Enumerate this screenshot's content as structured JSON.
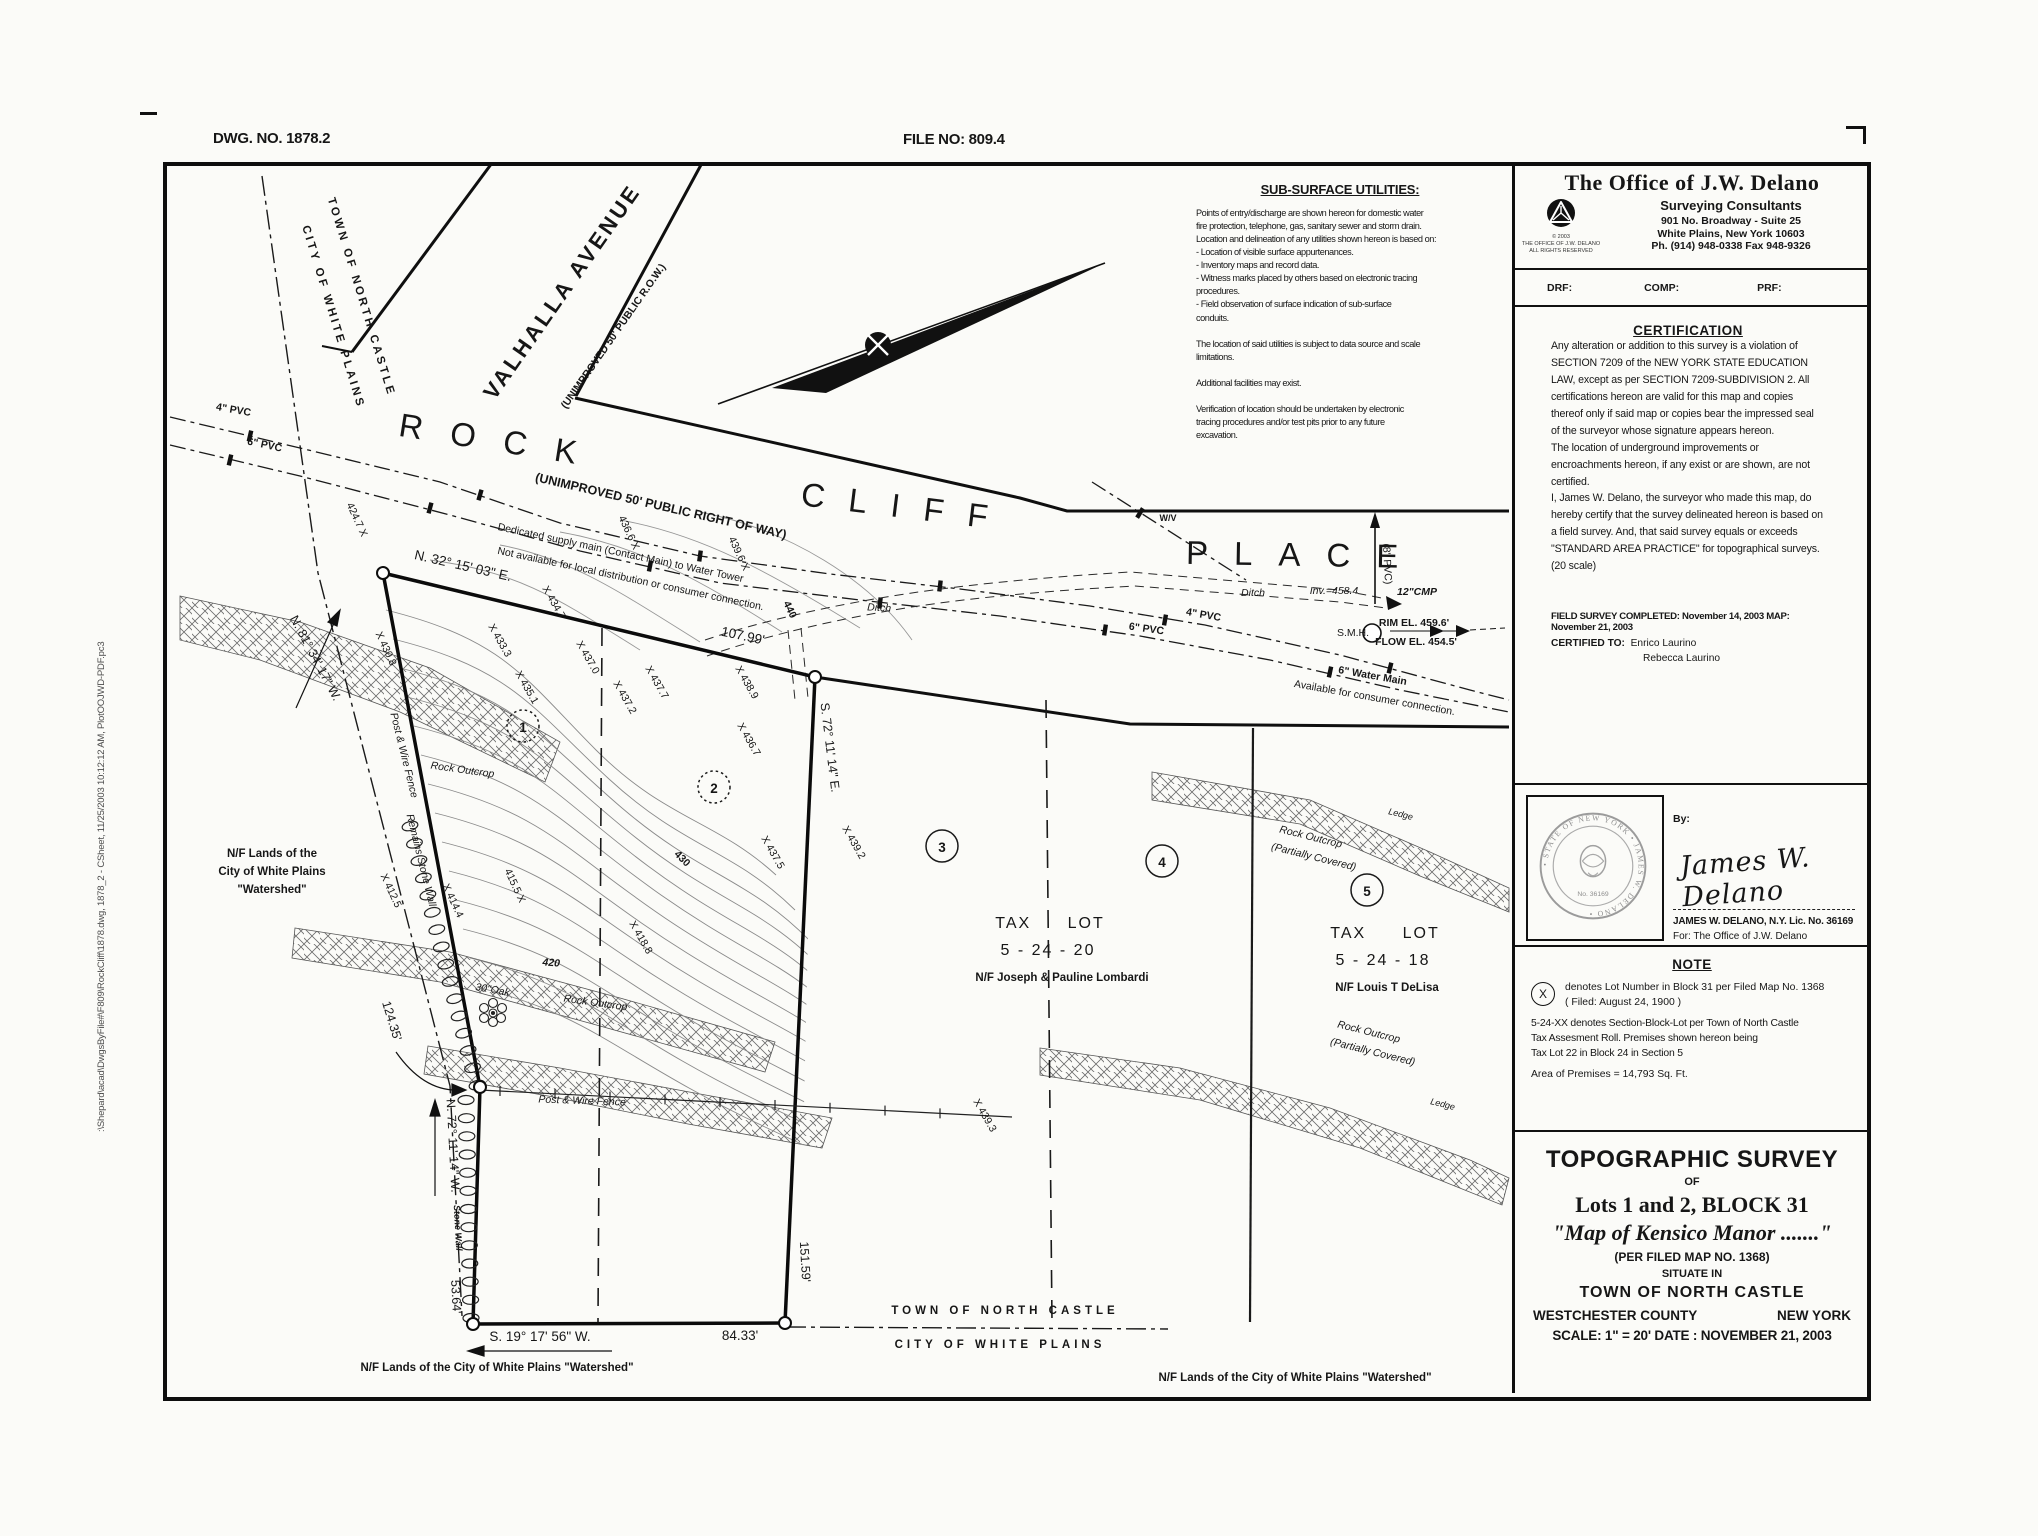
{
  "header": {
    "dwg_no": "DWG. NO.  1878.2",
    "file_no": "FILE NO:  809.4"
  },
  "plot_stamp": ":\\Shepard\\acad\\DwgsByFile#\\F809\\RockCliff\\1878.dwg, 1878_2 - CSheet, 11/25/2003 10:12:12 AM, PlotOOJWD-PDF.pc3",
  "firm": {
    "name": "The Office of J.W. Delano",
    "subtitle": "Surveying Consultants",
    "address1": "901 No. Broadway - Suite 25",
    "address2": "White Plains, New York 10603",
    "phone": "Ph. (914) 948-0338 Fax 948-9326",
    "copyright": "© 2003\nTHE OFFICE OF J.W. DELANO\nALL RIGHTS RESERVED",
    "drf": "DRF:",
    "comp": "COMP:",
    "prf": "PRF:"
  },
  "utilities": {
    "title": "SUB-SURFACE UTILITIES:",
    "body": "Points of entry/discharge are shown hereon for domestic water\nfire protection, telephone, gas, sanitary sewer and storm drain.\nLocation and delineation of any utilities shown hereon is based on:\n- Location of visible surface appurtenances.\n- Inventory maps and record data.\n- Witness marks placed by others based on electronic tracing\n   procedures.\n- Field observation of surface indication of sub-surface\n   conduits.\n\nThe location of said utilities is subject to data source and scale\nlimitations.\n\nAdditional facilities may exist.\n\nVerification of location should be undertaken by electronic\ntracing procedures and/or test pits prior to any future\nexcavation."
  },
  "certification": {
    "title": "CERTIFICATION",
    "para1": "Any alteration or addition to this survey is a violation of SECTION 7209 of the NEW YORK STATE EDUCATION LAW, except as per SECTION 7209-SUBDIVISION 2.  All certifications hereon are valid for this map and copies thereof only if said map or copies bear the impressed seal of the surveyor whose signature appears hereon.",
    "para2": "The location of underground improvements or encroachments hereon, if any exist or are shown, are not certified.",
    "para3": "I, James W. Delano, the surveyor who made this map, do hereby certify that the survey delineated hereon is based on a field survey.  And, that said survey equals or exceeds \"STANDARD AREA PRACTICE\" for topographical surveys. (20 scale)",
    "field_survey": "FIELD SURVEY COMPLETED:  November 14, 2003  MAP:  November 21, 2003",
    "certified_to_label": "CERTIFIED TO:",
    "certified_to_1": "Enrico Laurino",
    "certified_to_2": "Rebecca Laurino"
  },
  "signature": {
    "by_label": "By:",
    "script_name": "James W. Delano",
    "name_line": "JAMES W. DELANO, N.Y. Lic. No. 36169",
    "for_line": "For:  The Office of J.W. Delano",
    "seal_arc_text": "• STATE OF NEW YORK • JAMES W. DELANO •",
    "seal_no": "No. 36169"
  },
  "note": {
    "title": "NOTE",
    "symbol": "X",
    "item1a": "denotes Lot Number in Block 31 per Filed Map No. 1368",
    "item1b": "( Filed:  August 24, 1900 )",
    "item2": "5-24-XX denotes Section-Block-Lot per Town of North Castle\nTax Assesment Roll.  Premises shown hereon being\nTax Lot 22 in Block 24 in Section 5",
    "item3": "Area of Premises = 14,793 Sq. Ft."
  },
  "title_block": {
    "line1": "TOPOGRAPHIC SURVEY",
    "line2": "OF",
    "line3": "Lots 1 and 2, BLOCK 31",
    "line4": "\"Map of Kensico Manor .......\"",
    "line5": "(PER FILED MAP NO. 1368)",
    "line6": "SITUATE IN",
    "line7": "TOWN OF NORTH CASTLE",
    "county": "WESTCHESTER COUNTY",
    "state": "NEW YORK",
    "scale_date": "SCALE: 1\" = 20'    DATE : NOVEMBER 21, 2003"
  },
  "map": {
    "labels": {
      "town_top1": "TOWN OF NORTH CASTLE",
      "town_top2": "CITY OF WHITE PLAINS",
      "valhalla": "VALHALLA AVENUE",
      "valhalla_sub": "(UNIMPROVED 50' PUBLIC R.O.W.)",
      "rock": "ROCK",
      "cliff": "CLIFF",
      "place": "PLACE",
      "row_sub": "(UNIMPROVED 50' PUBLIC RIGHT OF WAY)",
      "ded1": "Dedicated supply main (Contact Main) to Water Tower",
      "ded2": "Not available for local distribution or consumer connection.",
      "brg_n32": "N. 32° 15' 03\" E.",
      "d10799": "107.99'",
      "brg_n81": "N. 81° 34' 17\" W.",
      "brg_s72": "S. 72° 11' 14\" E.",
      "d15159": "151.59'",
      "brg_s19": "S. 19° 17' 56\" W.",
      "d8433": "84.33'",
      "brg_n72": "N. 72° 11' 14\" W.",
      "stonewall": "Stone Wall",
      "d5364": "53.64'",
      "d12435": "124.35'",
      "nf_l1": "N/F Lands of the",
      "nf_l2": "City of White Plains",
      "nf_l3": "\"Watershed\"",
      "nf_bl": "N/F Lands of the City of White Plains \"Watershed\"",
      "nf_br": "N/F Lands of the City of White Plains \"Watershed\"",
      "town_bot": "TOWN OF NORTH CASTLE",
      "city_bot": "CITY OF WHITE PLAINS",
      "tl20_1": "TAX LOT",
      "tl20_2": "5 - 24 - 20",
      "tl20_3": "N/F Joseph & Pauline Lombardi",
      "tl18_1": "TAX LOT",
      "tl18_2": "5 - 24 - 18",
      "tl18_3": "N/F Louis T DeLisa",
      "lot1": "1",
      "lot2": "2",
      "lot3": "3",
      "lot4": "4",
      "lot5": "5",
      "s4247": "424.7 X",
      "s4308": "X 430.8",
      "s4333": "X 433.3",
      "s4347": "X 434.7",
      "s4351": "X 435.1",
      "s4370": "X 437.0",
      "s4372": "X 437.2",
      "s4377": "X 437.7",
      "s4389": "X 438.9",
      "s4367": "X 436.7",
      "s4366": "436.6 X",
      "s4396": "439.6 X",
      "c440": "440",
      "s4432": "X 443.2",
      "s4375": "X 437.5",
      "s4392": "X 439.2",
      "s4393": "X 439.3",
      "s4155": "415.5 X",
      "s4144": "X 414.4",
      "s4125": "X 412.5",
      "s4188": "X 418.8",
      "c420": "420",
      "c430": "430",
      "oak": "30\"Oak",
      "ro1": "Rock Outcrop",
      "ro2": "Rock Outcrop",
      "ro_rt1": "Rock Outcrop",
      "ro_rt2": "(Partially Covered)",
      "ledge_t": "Ledge",
      "ro_rb1": "Rock Outcrop",
      "ro_rb2": "(Partially Covered)",
      "ledge_b": "Ledge",
      "fence_b": "Post & Wire Fence",
      "fence_w": "Post & Wire Fence",
      "remains": "Remains Stone Wall",
      "ditch_w": "Ditch",
      "ditch_e": "Ditch",
      "inv": "Inv.=458.4",
      "cmp": "12\"CMP",
      "pvc8": "(8\" PVC)",
      "smh": "S.M.H.",
      "rim": "RIM EL.  459.6'",
      "flow": "FLOW EL. 454.5'",
      "pvc4w": "4\" PVC",
      "pvc6w": "6\" PVC",
      "pvc4e": "4\" PVC",
      "pvc6e": "6\" PVC",
      "wm1": "6\" Water Main",
      "wm2": "Available for consumer connection.",
      "wv": "W/V"
    }
  }
}
